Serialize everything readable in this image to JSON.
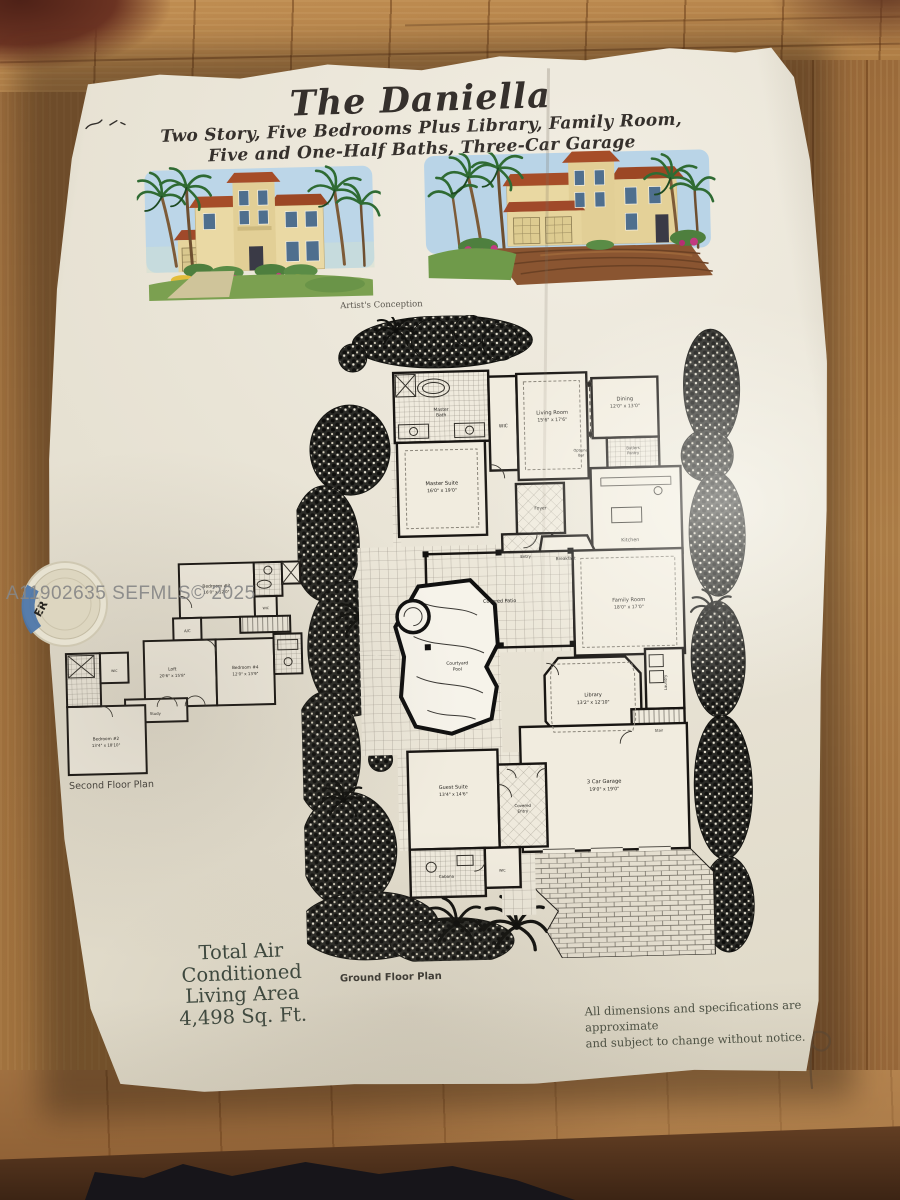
{
  "watermark_text": "A11902635  SEFMLS© 2025",
  "colors": {
    "paper": "#e9e4d6",
    "wood": "#a5763f",
    "ink": "#1a1a1a",
    "roof_terracotta": "#a64d28",
    "palm_green": "#2f6b33",
    "sky_wash": "#bcd6e8",
    "watermark_gray": "#878787",
    "sticker_blue": "#4a74a8",
    "area_text_green": "#3c473d"
  },
  "flyer": {
    "title": "The Daniella",
    "subtitle1": "Two Story, Five Bedrooms Plus Library, Family Room,",
    "subtitle2": "Five and One-Half Baths, Three-Car Garage",
    "artists_conception": "Artist's Conception",
    "ground_floor_caption": "Ground Floor Plan",
    "second_floor_caption": "Second Floor Plan",
    "total_air": {
      "l1": "Total Air",
      "l2": "Conditioned",
      "l3": "Living Area",
      "l4": "4,498 Sq. Ft."
    },
    "disclaimer1": "All dimensions and specifications are approximate",
    "disclaimer2": "and subject to change without notice.",
    "sticker_text": "ER",
    "ground_floor": {
      "master_bath": {
        "n1": "Master",
        "n2": "Bath"
      },
      "wic": {
        "name": "WIC"
      },
      "living": {
        "name": "Living Room",
        "dims": "15'6\" x 17'6\""
      },
      "dining": {
        "name": "Dining",
        "dims": "12'0\" x 13'0\""
      },
      "optional_bar": {
        "n1": "Optional",
        "n2": "Bar"
      },
      "butlers_pantry": {
        "n1": "Butlers",
        "n2": "Pantry"
      },
      "kitchen": {
        "name": "Kitchen"
      },
      "master_suite": {
        "name": "Master Suite",
        "dims": "16'0\" x 19'0\""
      },
      "foyer": {
        "name": "Foyer"
      },
      "entry": {
        "name": "Entry"
      },
      "breakfast": {
        "name": "Breakfast"
      },
      "covered_patio": {
        "name": "Covered Patio"
      },
      "family": {
        "name": "Family Room",
        "dims": "18'0\" x 17'0\""
      },
      "pool": {
        "n1": "Courtyard",
        "n2": "Pool"
      },
      "library": {
        "name": "Library",
        "dims": "13'2\" x 12'10\""
      },
      "laundry": {
        "name": "Laundry"
      },
      "stair": {
        "name": "Stair"
      },
      "garage": {
        "name": "3 Car Garage",
        "dims": "19'0\" x 19'0\""
      },
      "guest": {
        "name": "Guest Suite",
        "dims": "13'4\" x 14'6\""
      },
      "covered_entry": {
        "n1": "Covered",
        "n2": "Entry"
      },
      "cabana": {
        "name": "Cabana"
      },
      "wic2": {
        "name": "WIC"
      }
    },
    "second_floor": {
      "bedroom3": {
        "name": "Bedroom #3",
        "dims": "16'0\" x 12'0\""
      },
      "wic3": {
        "name": "WIC"
      },
      "ac": {
        "name": "A/C"
      },
      "loft": {
        "name": "Loft",
        "dims": "20'6\" x 15'8\""
      },
      "bedroom4": {
        "name": "Bedroom #4",
        "dims": "12'0\" x 13'9\""
      },
      "study": {
        "name": "Study"
      },
      "wic2f": {
        "name": "WIC"
      },
      "bedroom2": {
        "name": "Bedroom #2",
        "dims": "13'4\" x 18'10\""
      }
    }
  }
}
